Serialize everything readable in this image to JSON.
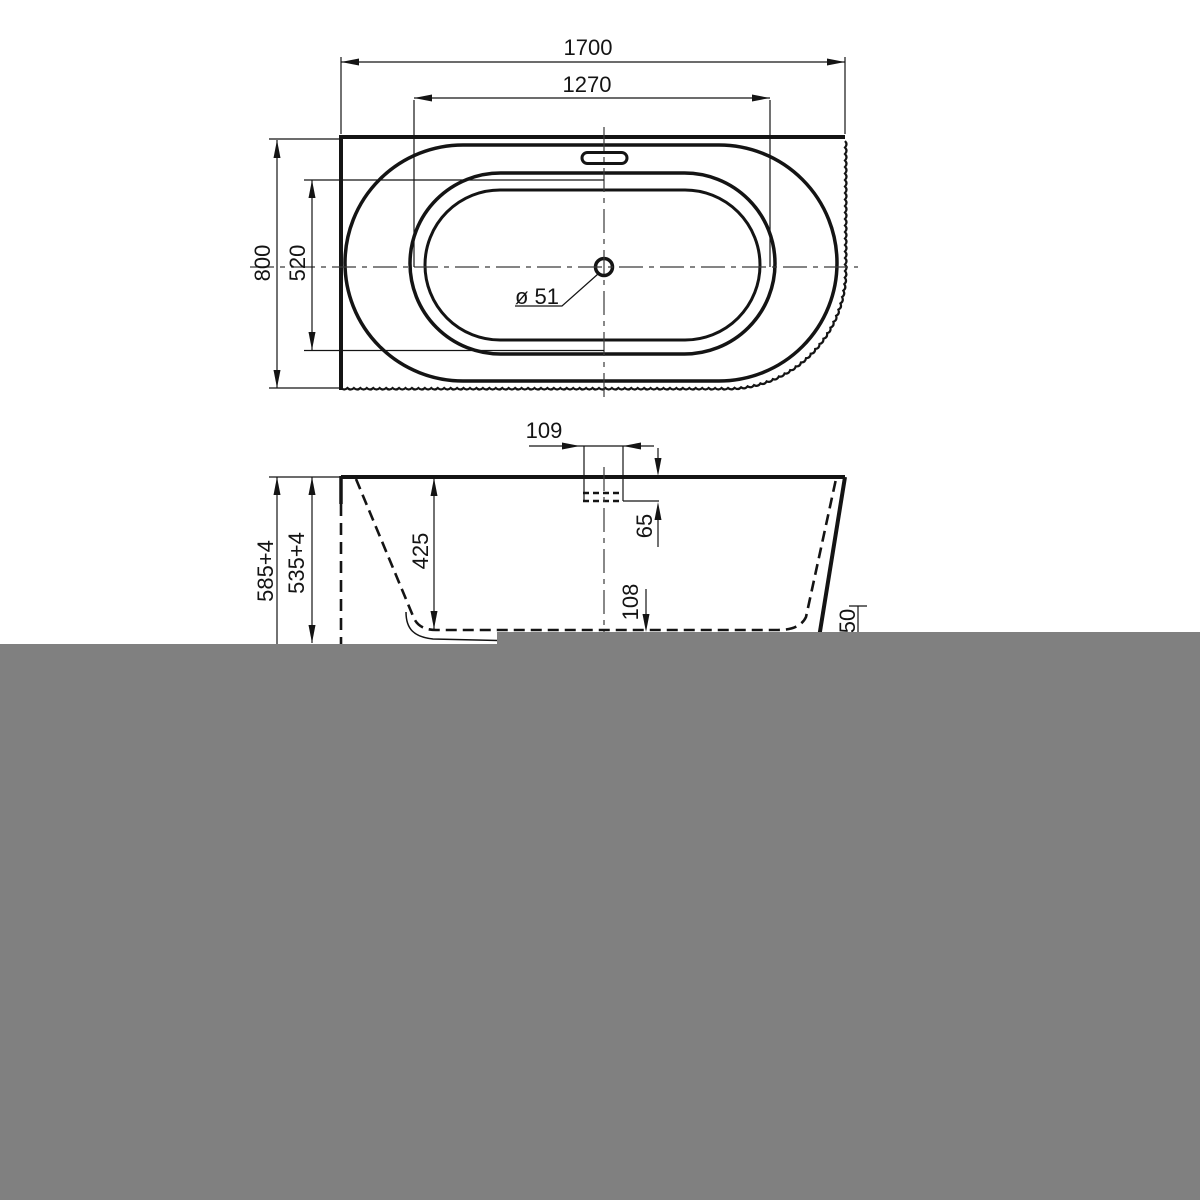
{
  "drawing_title": "bathtub-technical-drawing",
  "colors": {
    "line": "#141414",
    "gray": "#808080",
    "background": "#ffffff"
  },
  "top_view": {
    "length_overall": "1700",
    "length_inner": "1270",
    "width_overall": "800",
    "width_inner": "520",
    "drain_diameter": "ø 51"
  },
  "side_view": {
    "overflow_width": "109",
    "overflow_height": "65",
    "depth": "425",
    "bottom_offset": "108",
    "height_outer": "585+4",
    "height_inner": "535+4",
    "right_offset": "50"
  }
}
